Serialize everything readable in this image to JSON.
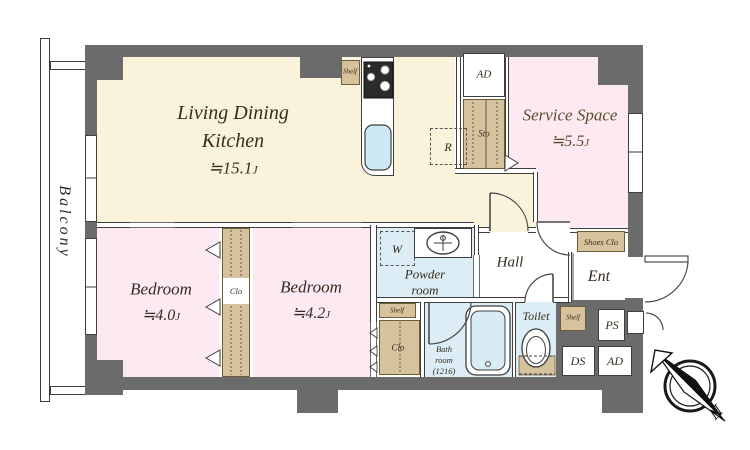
{
  "plan": {
    "balcony": "Balcony",
    "ldk": {
      "line1": "Living Dining",
      "line2": "Kitchen",
      "area": "≒15.1",
      "unit": "J"
    },
    "service_space": {
      "name": "Service Space",
      "area": "≒5.5",
      "unit": "J"
    },
    "bedroom_a": {
      "name": "Bedroom",
      "area": "≒4.0",
      "unit": "J"
    },
    "bedroom_b": {
      "name": "Bedroom",
      "area": "≒4.2",
      "unit": "J"
    },
    "powder_room": {
      "line1": "Powder",
      "line2": "room"
    },
    "bath_room": {
      "line1": "Bath",
      "line2": "room",
      "line3": "(1216)"
    },
    "toilet": "Toilet",
    "hall": "Hall",
    "entrance": "Ent",
    "labels": {
      "ad_top": "AD",
      "ad_bottom": "AD",
      "sto": "Sto",
      "fridge": "R",
      "washer": "W",
      "shelf_kitchen": "Shelf",
      "shelf_powder": "Shelf",
      "shelf_toilet": "Shelf",
      "shoes_closet": "Shoes Clo",
      "closet_bedrooms": "Clo",
      "closet_hall": "Clo",
      "ps": "PS",
      "ds": "DS"
    },
    "compass_north": "N"
  },
  "colors": {
    "wall": "#6b6b6b",
    "ldk_floor": "#faf3dc",
    "pink_floor": "#fce9f2",
    "wet_floor": "#dcedf5",
    "storage_tan": "#d6c29c",
    "line": "#3e3e3e"
  }
}
